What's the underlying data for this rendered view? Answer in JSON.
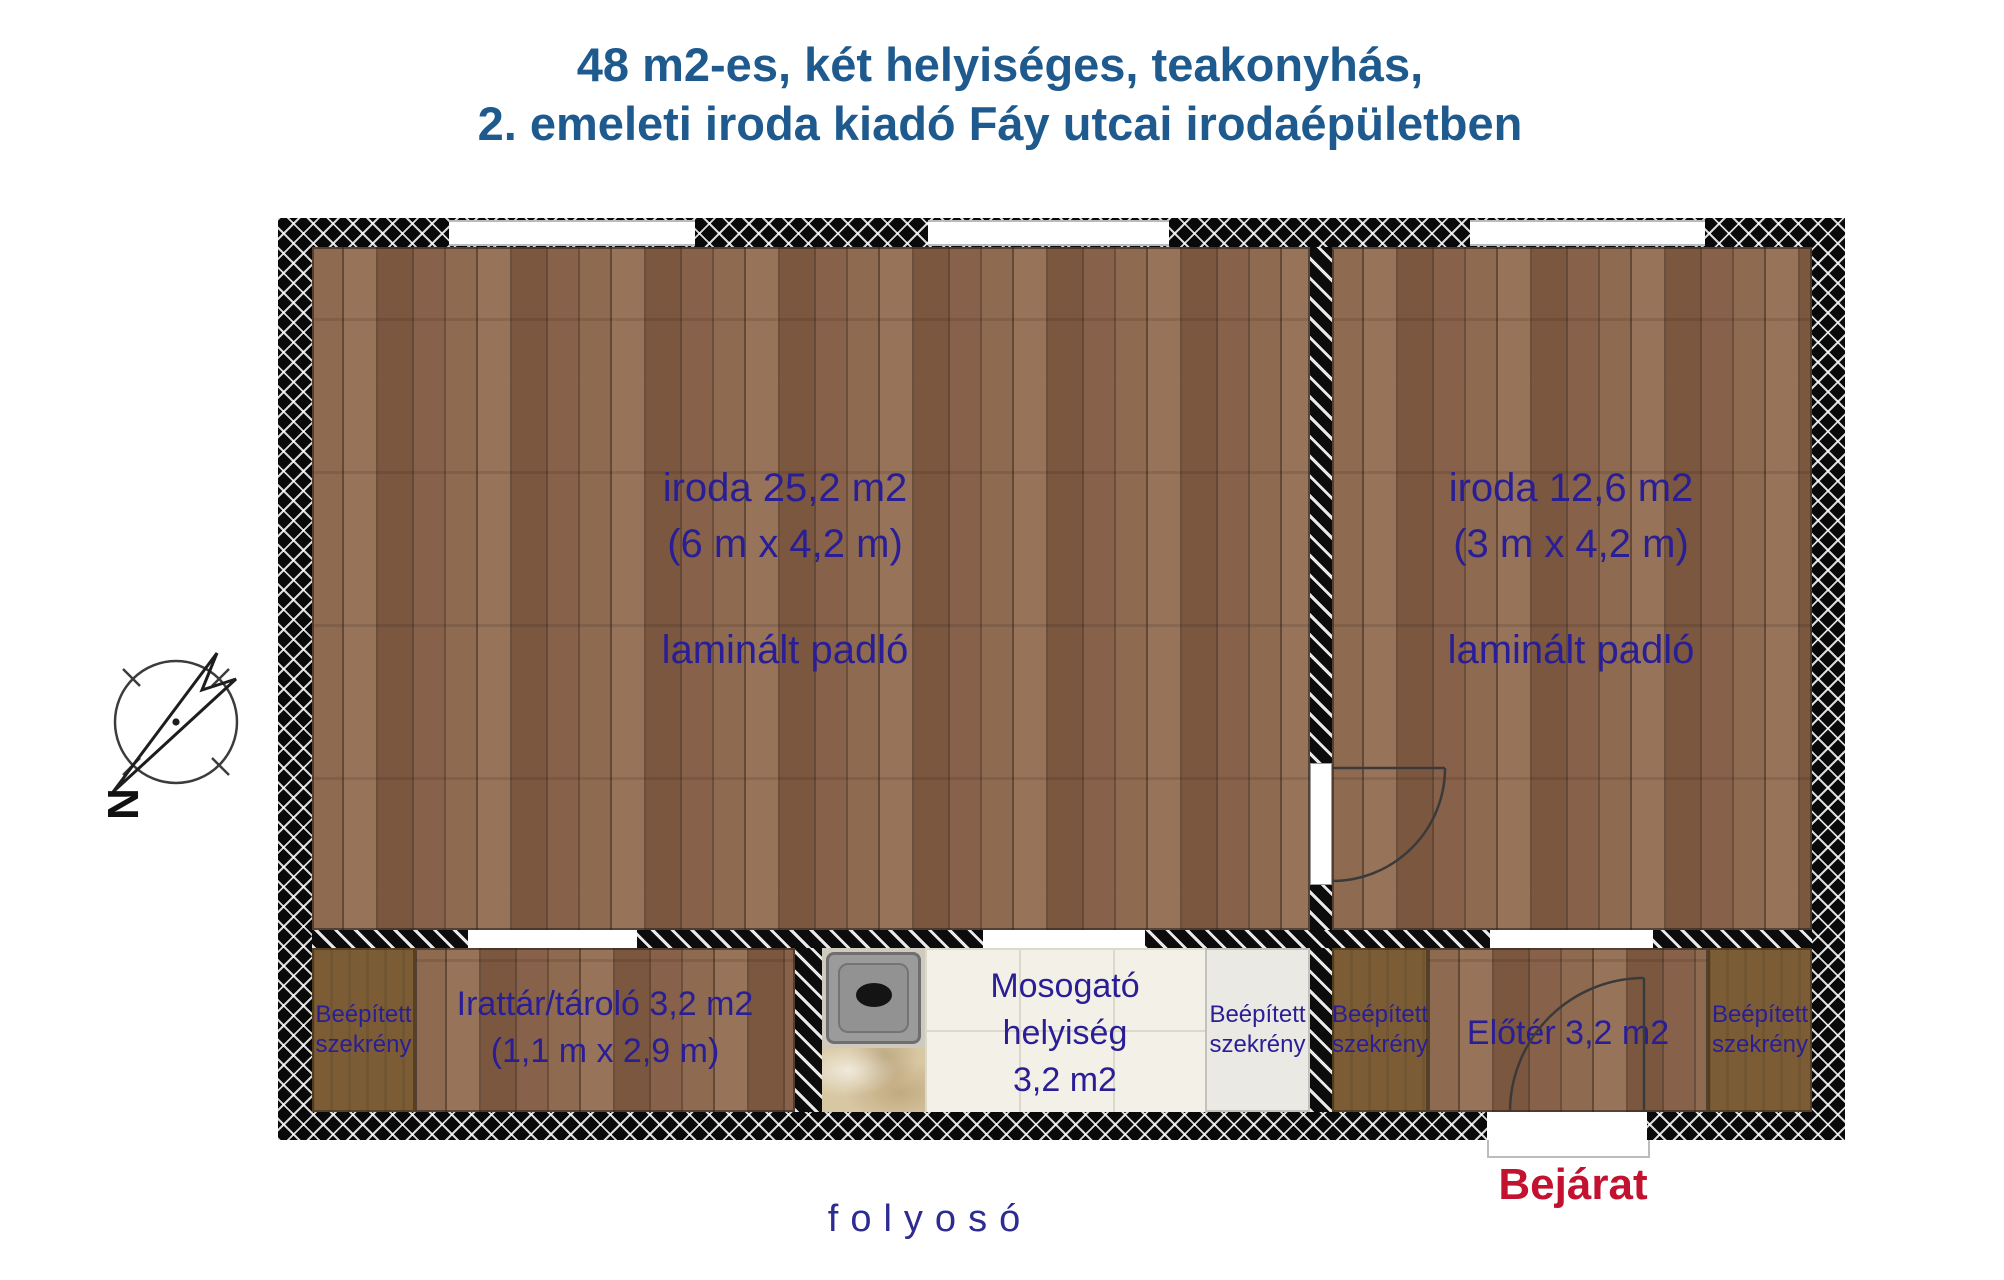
{
  "title": {
    "line1": "48 m2-es, két helyiséges, teakonyhás,",
    "line2": "2. emeleti iroda kiadó Fáy utcai irodaépületben"
  },
  "rooms": {
    "office_left": {
      "name": "iroda 25,2 m2",
      "dimensions": "(6 m x 4,2 m)",
      "floor": "laminált padló"
    },
    "office_right": {
      "name": "iroda 12,6 m2",
      "dimensions": "(3 m x 4,2 m)",
      "floor": "laminált padló"
    },
    "storage": {
      "name": "Irattár/tároló 3,2 m2",
      "dimensions": "(1,1 m x 2,9 m)"
    },
    "kitchen": {
      "line1": "Mosogató",
      "line2": "helyiség",
      "line3": "3,2 m2"
    },
    "hall": {
      "name": "Előtér 3,2 m2"
    }
  },
  "cabinet": {
    "line1": "Beépített",
    "line2": "szekrény"
  },
  "labels": {
    "entrance": "Bejárat",
    "corridor": "folyosó",
    "compass_north": "N"
  },
  "colors": {
    "title_blue": "#1e5a8e",
    "room_text_navy": "#2a1e96",
    "entrance_red": "#c3122f",
    "corridor_navy": "#2e2c90",
    "wall_black": "#090909",
    "wood_brown": "#8a654c",
    "cabinet_brown": "#7c5c35",
    "cabinet_gray": "#ebe9e3",
    "tile_cream": "#f3f0e7",
    "marble_beige": "#d8c7a3"
  }
}
